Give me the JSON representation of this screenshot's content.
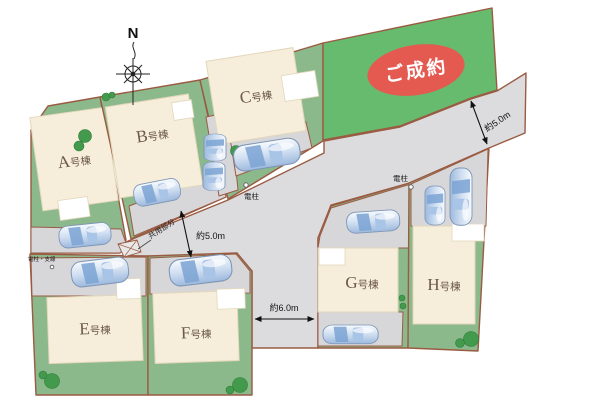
{
  "compass": {
    "label": "N"
  },
  "lots": {
    "a": {
      "letter": "A",
      "suffix": "号棟"
    },
    "b": {
      "letter": "B",
      "suffix": "号棟"
    },
    "c": {
      "letter": "C",
      "suffix": "号棟"
    },
    "e": {
      "letter": "E",
      "suffix": "号棟"
    },
    "f": {
      "letter": "F",
      "suffix": "号棟"
    },
    "g": {
      "letter": "G",
      "suffix": "号棟"
    },
    "h": {
      "letter": "H",
      "suffix": "号棟"
    }
  },
  "sold": {
    "label": "ご成約"
  },
  "dimensions": {
    "road_exit_width": "約5.0m",
    "road_main_width": "約5.0m",
    "road_south_width": "約6.0m"
  },
  "annotations": {
    "pole_top": "電柱",
    "pole_right": "電柱",
    "pole_guywire": "電柱・支線",
    "common_area": "共用部分"
  },
  "colors": {
    "parcel_green": "#8cb98c",
    "sold_green": "#67bb6e",
    "building_cream": "#f6eeda",
    "road_gray": "#dcdcde",
    "parking_gray": "#d7d7d9",
    "boundary_brown": "#9a5b42",
    "badge_red": "#e45a50",
    "car_blue": "#9db9dd",
    "label_brown": "#6b5847"
  }
}
